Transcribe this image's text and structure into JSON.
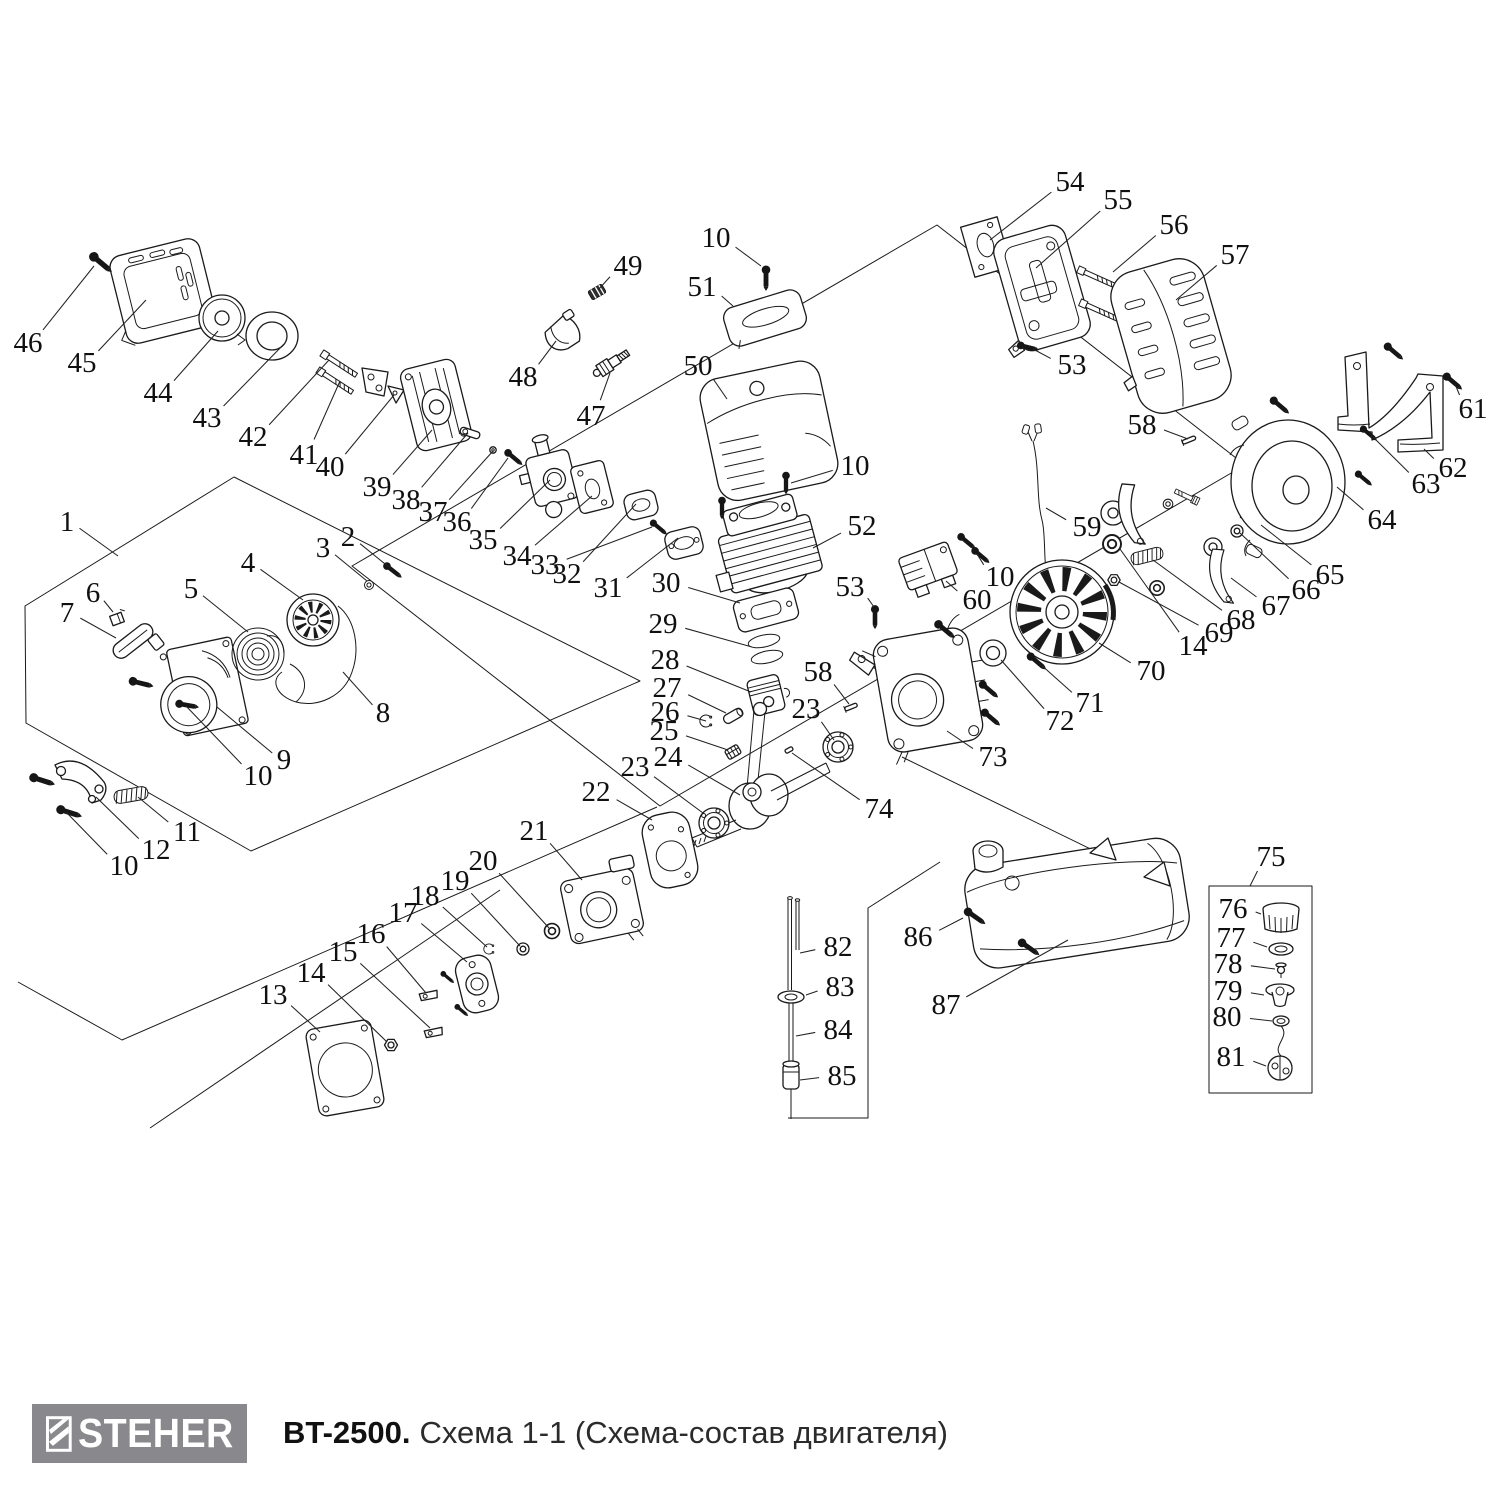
{
  "footer": {
    "logo_text": "STEHER",
    "title_model": "BT-2500.",
    "title_rest": "Схема 1-1 (Схема-состав двигателя)"
  },
  "colors": {
    "logo_bg": "#88888d",
    "line": "#1a1a1a"
  },
  "diagram": {
    "description": "Exploded parts diagram of BT-2500 trimmer engine with numbered callouts",
    "labels": [
      {
        "n": "1",
        "x": 67,
        "y": 522,
        "tx": 118,
        "ty": 556
      },
      {
        "n": "2",
        "x": 348,
        "y": 537,
        "tx": 390,
        "ty": 568
      },
      {
        "n": "3",
        "x": 323,
        "y": 548,
        "tx": 367,
        "ty": 581
      },
      {
        "n": "4",
        "x": 248,
        "y": 563,
        "tx": 303,
        "ty": 600
      },
      {
        "n": "5",
        "x": 191,
        "y": 589,
        "tx": 248,
        "ty": 632
      },
      {
        "n": "6",
        "x": 93,
        "y": 593,
        "tx": 113,
        "ty": 612
      },
      {
        "n": "7",
        "x": 67,
        "y": 613,
        "tx": 116,
        "ty": 638
      },
      {
        "n": "8",
        "x": 383,
        "y": 713,
        "tx": 343,
        "ty": 672
      },
      {
        "n": "9",
        "x": 284,
        "y": 760,
        "tx": 217,
        "ty": 707
      },
      {
        "n": "10",
        "x": 258,
        "y": 776,
        "tx": 186,
        "ty": 706
      },
      {
        "n": "10",
        "x": 124,
        "y": 866,
        "tx": 66,
        "ty": 812
      },
      {
        "n": "11",
        "x": 187,
        "y": 832,
        "tx": 138,
        "ty": 797
      },
      {
        "n": "12",
        "x": 156,
        "y": 850,
        "tx": 96,
        "ty": 797
      },
      {
        "n": "13",
        "x": 273,
        "y": 995,
        "tx": 320,
        "ty": 1032
      },
      {
        "n": "14",
        "x": 311,
        "y": 973,
        "tx": 387,
        "ty": 1042
      },
      {
        "n": "15",
        "x": 343,
        "y": 952,
        "tx": 430,
        "ty": 1028
      },
      {
        "n": "16",
        "x": 371,
        "y": 934,
        "tx": 426,
        "ty": 993
      },
      {
        "n": "17",
        "x": 403,
        "y": 913,
        "tx": 467,
        "ty": 962
      },
      {
        "n": "18",
        "x": 425,
        "y": 896,
        "tx": 487,
        "ty": 947
      },
      {
        "n": "19",
        "x": 455,
        "y": 881,
        "tx": 520,
        "ty": 946
      },
      {
        "n": "20",
        "x": 483,
        "y": 861,
        "tx": 549,
        "ty": 928
      },
      {
        "n": "21",
        "x": 534,
        "y": 831,
        "tx": 582,
        "ty": 880
      },
      {
        "n": "22",
        "x": 596,
        "y": 792,
        "tx": 652,
        "ty": 820
      },
      {
        "n": "23",
        "x": 635,
        "y": 767,
        "tx": 703,
        "ty": 813
      },
      {
        "n": "24",
        "x": 668,
        "y": 757,
        "tx": 740,
        "ty": 795
      },
      {
        "n": "25",
        "x": 664,
        "y": 731,
        "tx": 728,
        "ty": 750
      },
      {
        "n": "26",
        "x": 665,
        "y": 712,
        "tx": 706,
        "ty": 721
      },
      {
        "n": "27",
        "x": 667,
        "y": 688,
        "tx": 726,
        "ty": 713
      },
      {
        "n": "28",
        "x": 665,
        "y": 660,
        "tx": 751,
        "ty": 692
      },
      {
        "n": "29",
        "x": 663,
        "y": 624,
        "tx": 752,
        "ty": 647
      },
      {
        "n": "30",
        "x": 666,
        "y": 583,
        "tx": 740,
        "ty": 603
      },
      {
        "n": "31",
        "x": 608,
        "y": 588,
        "tx": 678,
        "ty": 538
      },
      {
        "n": "32",
        "x": 567,
        "y": 574,
        "tx": 636,
        "ty": 504
      },
      {
        "n": "33",
        "x": 545,
        "y": 565,
        "tx": 652,
        "ty": 527
      },
      {
        "n": "34",
        "x": 517,
        "y": 556,
        "tx": 592,
        "ty": 496
      },
      {
        "n": "35",
        "x": 483,
        "y": 540,
        "tx": 550,
        "ty": 480
      },
      {
        "n": "36",
        "x": 457,
        "y": 522,
        "tx": 508,
        "ty": 458
      },
      {
        "n": "37",
        "x": 433,
        "y": 512,
        "tx": 493,
        "ty": 451
      },
      {
        "n": "38",
        "x": 406,
        "y": 500,
        "tx": 468,
        "ty": 433
      },
      {
        "n": "39",
        "x": 377,
        "y": 487,
        "tx": 432,
        "ty": 430
      },
      {
        "n": "40",
        "x": 330,
        "y": 467,
        "tx": 394,
        "ty": 395
      },
      {
        "n": "41",
        "x": 304,
        "y": 455,
        "tx": 340,
        "ty": 381
      },
      {
        "n": "42",
        "x": 253,
        "y": 437,
        "tx": 329,
        "ty": 360
      },
      {
        "n": "43",
        "x": 207,
        "y": 418,
        "tx": 284,
        "ty": 344
      },
      {
        "n": "44",
        "x": 158,
        "y": 393,
        "tx": 218,
        "ty": 331
      },
      {
        "n": "45",
        "x": 82,
        "y": 363,
        "tx": 146,
        "ty": 300
      },
      {
        "n": "46",
        "x": 28,
        "y": 343,
        "tx": 94,
        "ty": 266
      },
      {
        "n": "47",
        "x": 591,
        "y": 416,
        "tx": 610,
        "ty": 373
      },
      {
        "n": "48",
        "x": 523,
        "y": 377,
        "tx": 556,
        "ty": 341
      },
      {
        "n": "49",
        "x": 628,
        "y": 266,
        "tx": 598,
        "ty": 290
      },
      {
        "n": "50",
        "x": 698,
        "y": 366,
        "tx": 727,
        "ty": 399
      },
      {
        "n": "51",
        "x": 702,
        "y": 287,
        "tx": 733,
        "ty": 306
      },
      {
        "n": "10",
        "x": 716,
        "y": 238,
        "tx": 761,
        "ty": 266
      },
      {
        "n": "52",
        "x": 862,
        "y": 526,
        "tx": 813,
        "ty": 548
      },
      {
        "n": "10",
        "x": 855,
        "y": 466,
        "tx": 791,
        "ty": 483
      },
      {
        "n": "53",
        "x": 1072,
        "y": 365,
        "tx": 1033,
        "ty": 349
      },
      {
        "n": "53",
        "x": 850,
        "y": 587,
        "tx": 874,
        "ty": 607
      },
      {
        "n": "54",
        "x": 1070,
        "y": 182,
        "tx": 990,
        "ty": 240
      },
      {
        "n": "55",
        "x": 1118,
        "y": 200,
        "tx": 1036,
        "ty": 268
      },
      {
        "n": "56",
        "x": 1174,
        "y": 225,
        "tx": 1113,
        "ty": 272
      },
      {
        "n": "57",
        "x": 1235,
        "y": 255,
        "tx": 1176,
        "ty": 300
      },
      {
        "n": "58",
        "x": 1142,
        "y": 425,
        "tx": 1188,
        "ty": 439
      },
      {
        "n": "58",
        "x": 818,
        "y": 672,
        "tx": 849,
        "ty": 704
      },
      {
        "n": "59",
        "x": 1087,
        "y": 527,
        "tx": 1046,
        "ty": 508
      },
      {
        "n": "60",
        "x": 977,
        "y": 600,
        "tx": 946,
        "ty": 581
      },
      {
        "n": "10",
        "x": 1000,
        "y": 577,
        "tx": 977,
        "ty": 554
      },
      {
        "n": "61",
        "x": 1473,
        "y": 409,
        "tx": 1455,
        "ty": 384
      },
      {
        "n": "62",
        "x": 1453,
        "y": 468,
        "tx": 1424,
        "ty": 449
      },
      {
        "n": "63",
        "x": 1426,
        "y": 484,
        "tx": 1371,
        "ty": 435
      },
      {
        "n": "64",
        "x": 1382,
        "y": 520,
        "tx": 1337,
        "ty": 487
      },
      {
        "n": "65",
        "x": 1330,
        "y": 575,
        "tx": 1261,
        "ty": 525
      },
      {
        "n": "66",
        "x": 1306,
        "y": 590,
        "tx": 1240,
        "ty": 533
      },
      {
        "n": "67",
        "x": 1276,
        "y": 606,
        "tx": 1231,
        "ty": 578
      },
      {
        "n": "68",
        "x": 1241,
        "y": 620,
        "tx": 1153,
        "ty": 560
      },
      {
        "n": "69",
        "x": 1219,
        "y": 633,
        "tx": 1119,
        "ty": 582
      },
      {
        "n": "14",
        "x": 1193,
        "y": 646,
        "tx": 1120,
        "ty": 549
      },
      {
        "n": "70",
        "x": 1151,
        "y": 671,
        "tx": 1099,
        "ty": 643
      },
      {
        "n": "71",
        "x": 1090,
        "y": 703,
        "tx": 1039,
        "ty": 663
      },
      {
        "n": "72",
        "x": 1060,
        "y": 721,
        "tx": 1001,
        "ty": 660
      },
      {
        "n": "73",
        "x": 993,
        "y": 757,
        "tx": 947,
        "ty": 731
      },
      {
        "n": "74",
        "x": 879,
        "y": 809,
        "tx": 792,
        "ty": 753
      },
      {
        "n": "23",
        "x": 806,
        "y": 709,
        "tx": 834,
        "ty": 740
      },
      {
        "n": "75",
        "x": 1271,
        "y": 857,
        "tx": 1250,
        "ty": 886
      },
      {
        "n": "76",
        "x": 1233,
        "y": 909,
        "tx": 1261,
        "ty": 914
      },
      {
        "n": "77",
        "x": 1231,
        "y": 938,
        "tx": 1267,
        "ty": 947
      },
      {
        "n": "78",
        "x": 1228,
        "y": 964,
        "tx": 1275,
        "ty": 969
      },
      {
        "n": "79",
        "x": 1228,
        "y": 991,
        "tx": 1264,
        "ty": 995
      },
      {
        "n": "80",
        "x": 1227,
        "y": 1017,
        "tx": 1272,
        "ty": 1021
      },
      {
        "n": "81",
        "x": 1231,
        "y": 1057,
        "tx": 1266,
        "ty": 1066
      },
      {
        "n": "82",
        "x": 838,
        "y": 947,
        "tx": 800,
        "ty": 953
      },
      {
        "n": "83",
        "x": 840,
        "y": 987,
        "tx": 806,
        "ty": 995
      },
      {
        "n": "84",
        "x": 838,
        "y": 1030,
        "tx": 796,
        "ty": 1036
      },
      {
        "n": "85",
        "x": 842,
        "y": 1076,
        "tx": 800,
        "ty": 1080
      },
      {
        "n": "86",
        "x": 918,
        "y": 937,
        "tx": 963,
        "ty": 918
      },
      {
        "n": "87",
        "x": 946,
        "y": 1005,
        "tx": 1068,
        "ty": 940
      }
    ]
  }
}
